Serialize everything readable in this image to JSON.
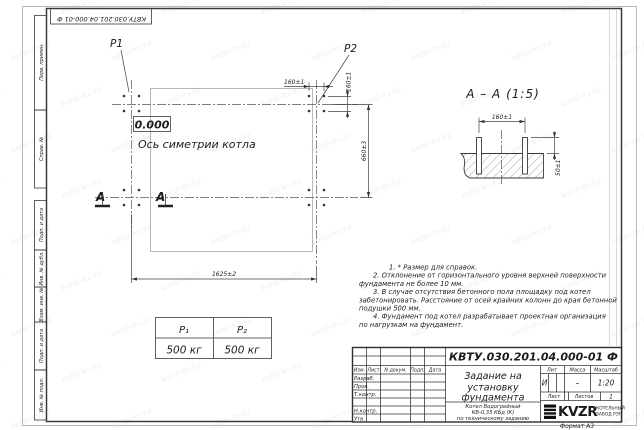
{
  "watermark": {
    "text": "kotel-kv.kz"
  },
  "frame": {
    "top_stamp": "КВТУ.030.201.04.000-01  Ф",
    "side_labels": [
      "Перв. примен.",
      "Справ. №",
      "Подп. и дата",
      "Инв. № дубл.",
      "Взам. инв. №",
      "Подп. и дата",
      "Инв. № подл."
    ],
    "format_note": "Формат А3"
  },
  "plan": {
    "p1": "P1",
    "p2": "P2",
    "elevation": "0.000",
    "axis_label": "Ось симетрии котла",
    "section_letter": "А",
    "dims": {
      "d160_top": "160±1",
      "d160_side": "160±1",
      "d660": "660±3",
      "d1625": "1625±2"
    }
  },
  "section": {
    "title": "А – А (1:5)",
    "dims": {
      "d160": "160±1",
      "d50": "50±1"
    }
  },
  "load_table": {
    "headers": [
      "P₁",
      "P₂"
    ],
    "values": [
      "500 кг",
      "500 кг"
    ]
  },
  "notes": {
    "lines": [
      "1. * Размер для справок.",
      "2. Отклонение от горизонтального уровня верхней поверхности",
      "фундамента не более 10 мм.",
      "3. В случае отсутствия бетонного пола площадку под котел",
      "забетонировать. Расстояние от осей крайних колонн до края бетонной",
      "подушки 500 мм.",
      "4. Фундамент под котел разрабатывает проектная организация",
      "по нагрузкам на фундамент."
    ]
  },
  "title_block": {
    "doc_number": "КВТУ.030.201.04.000-01 Ф",
    "title_lines": [
      "Задание на",
      "установку",
      "фундамента"
    ],
    "product_lines": [
      "Котел Водогрейный",
      "КВ-0,35 КБд (К)",
      "по техническому заданию"
    ],
    "header_cols": [
      "Изм.",
      "Лист",
      "N докум.",
      "Подп.",
      "Дата"
    ],
    "rows": [
      "Разраб.",
      "Пров.",
      "Т.контр.",
      "Н.контр.",
      "Утв."
    ],
    "lit_label": "Лит",
    "mass_label": "Масса",
    "scale_label": "Масштаб",
    "lit_value": "И",
    "mass_value": "–",
    "scale_value": "1:20",
    "sheet_label": "Лист",
    "sheets_label": "Листов",
    "sheets_value": "1",
    "company": {
      "name": "KVZR",
      "tagline1": "КОТЕЛЬНЫЙ",
      "tagline2": "ЗАВОД РЭП"
    }
  }
}
